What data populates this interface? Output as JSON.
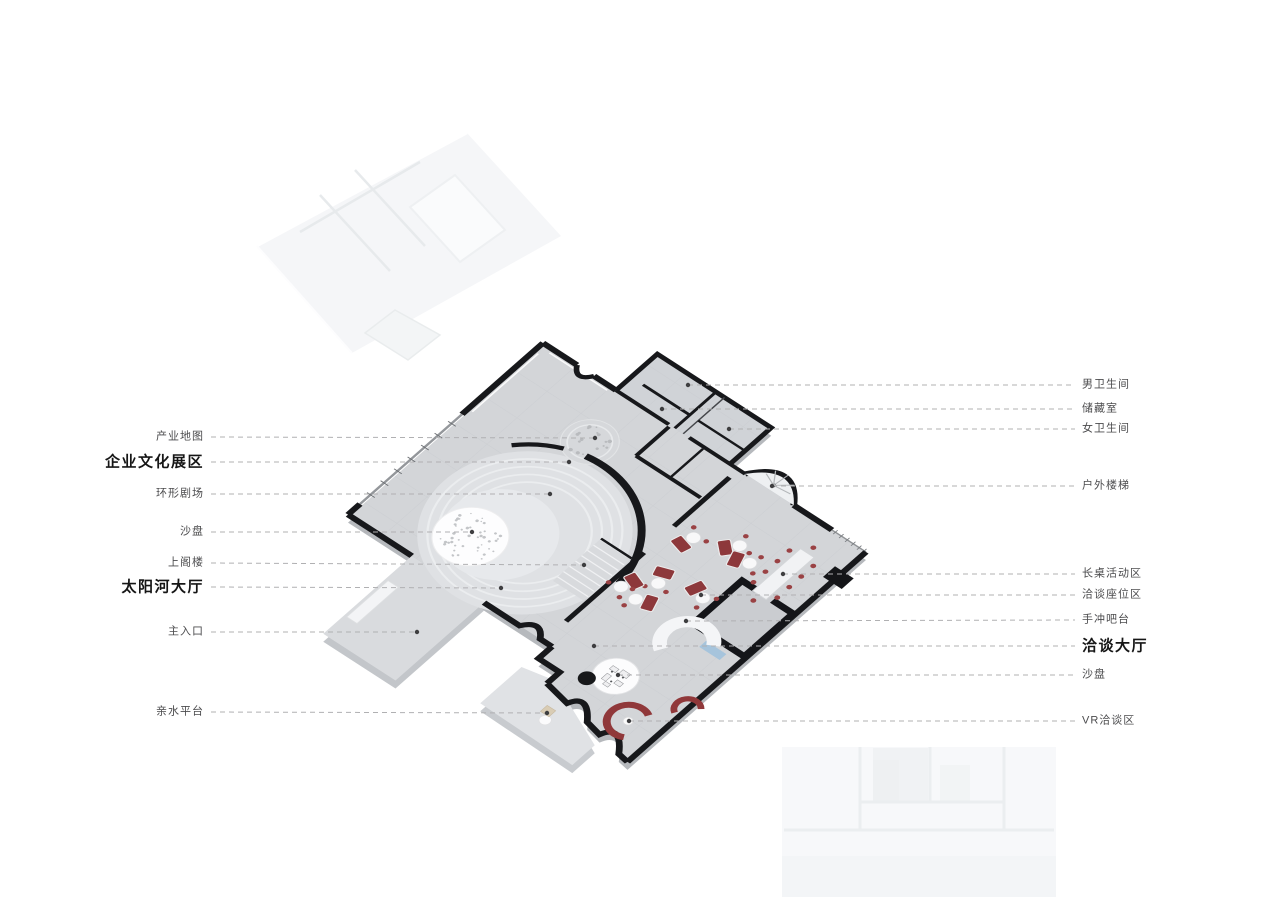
{
  "diagram": {
    "type": "axonometric-floor-plan",
    "colors": {
      "background": "#ffffff",
      "floor": "#d3d5d8",
      "wall": "#17181b",
      "ghost_plate": "#f5f6f8",
      "accent_red": "#8d383b",
      "accent_blue": "#a6c4dc",
      "leader_line": "#b0b0b2",
      "leader_dot": "#3e3e40",
      "label_text": "#4c4c4e",
      "label_bold_text": "#161616"
    },
    "labels": {
      "left": [
        {
          "text": "产业地图",
          "bold": false,
          "y": 437,
          "tx": 595,
          "ty": 438
        },
        {
          "text": "企业文化展区",
          "bold": true,
          "y": 462,
          "tx": 569,
          "ty": 462
        },
        {
          "text": "环形剧场",
          "bold": false,
          "y": 494,
          "tx": 550,
          "ty": 494
        },
        {
          "text": "沙盘",
          "bold": false,
          "y": 532,
          "tx": 472,
          "ty": 532
        },
        {
          "text": "上阁楼",
          "bold": false,
          "y": 563,
          "tx": 584,
          "ty": 565
        },
        {
          "text": "太阳河大厅",
          "bold": true,
          "y": 587,
          "tx": 501,
          "ty": 588
        },
        {
          "text": "主入口",
          "bold": false,
          "y": 632,
          "tx": 417,
          "ty": 632
        },
        {
          "text": "亲水平台",
          "bold": false,
          "y": 712,
          "tx": 547,
          "ty": 713
        }
      ],
      "right": [
        {
          "text": "男卫生间",
          "bold": false,
          "y": 385,
          "tx": 688,
          "ty": 385
        },
        {
          "text": "储藏室",
          "bold": false,
          "y": 409,
          "tx": 662,
          "ty": 409
        },
        {
          "text": "女卫生间",
          "bold": false,
          "y": 429,
          "tx": 729,
          "ty": 429
        },
        {
          "text": "户外楼梯",
          "bold": false,
          "y": 486,
          "tx": 772,
          "ty": 486
        },
        {
          "text": "长桌活动区",
          "bold": false,
          "y": 574,
          "tx": 783,
          "ty": 574
        },
        {
          "text": "洽谈座位区",
          "bold": false,
          "y": 595,
          "tx": 701,
          "ty": 595
        },
        {
          "text": "手冲吧台",
          "bold": false,
          "y": 620,
          "tx": 686,
          "ty": 621
        },
        {
          "text": "洽谈大厅",
          "bold": true,
          "y": 646,
          "tx": 594,
          "ty": 646
        },
        {
          "text": "沙盘",
          "bold": false,
          "y": 675,
          "tx": 618,
          "ty": 675
        },
        {
          "text": "VR洽谈区",
          "bold": false,
          "y": 721,
          "tx": 629,
          "ty": 721
        }
      ]
    },
    "layout": {
      "left_label_right_edge": 204,
      "left_line_start_x": 211,
      "right_label_left_edge": 1082,
      "right_line_end_x": 1075
    }
  }
}
